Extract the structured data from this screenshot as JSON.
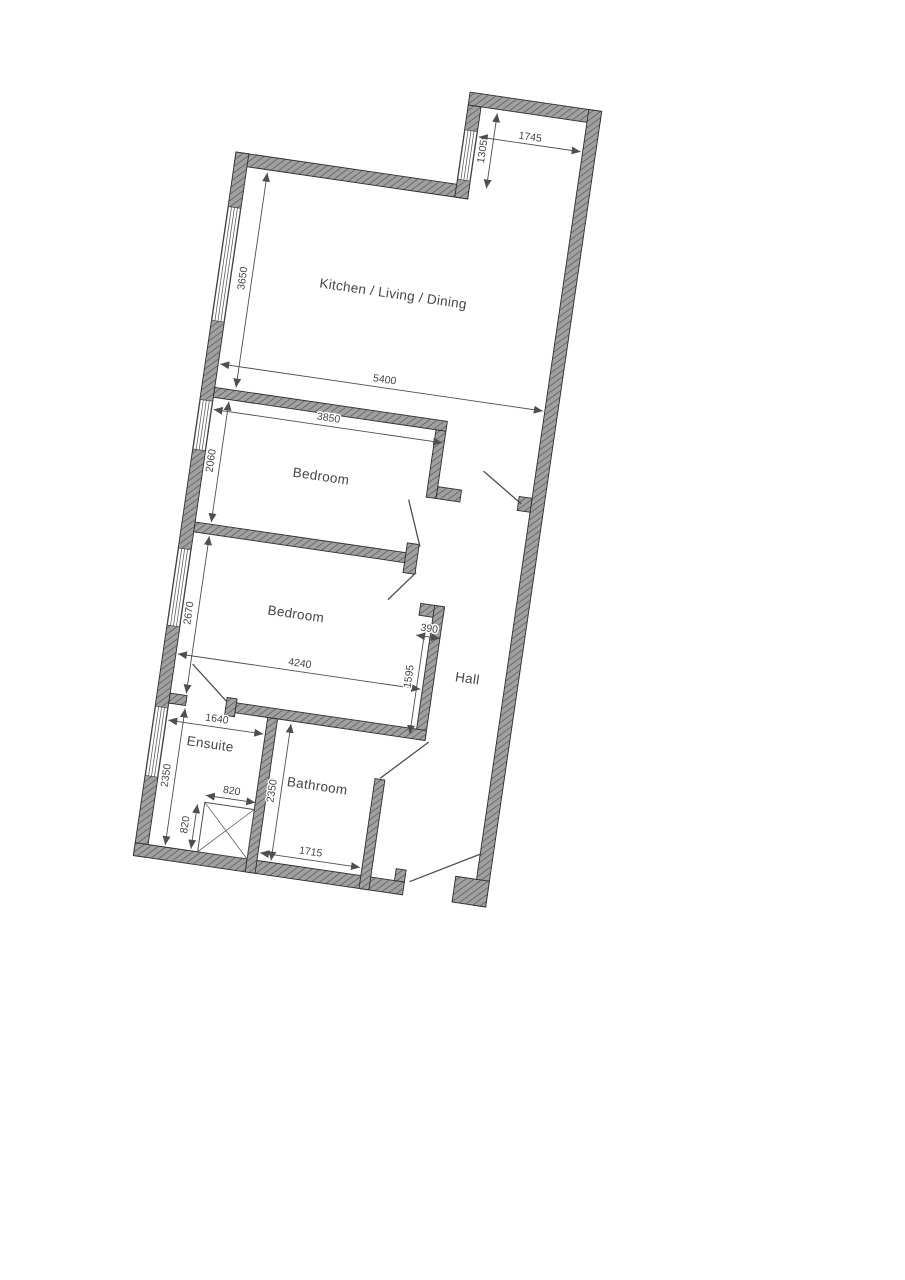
{
  "title": "Apartment floor plan",
  "colors": {
    "bg": "#ffffff",
    "wall_fill": "#a0a0a0",
    "wall_hatch": "#4a4a4a",
    "wall_outline": "#2e2e2e",
    "line": "#4f4f4f",
    "text": "#454545"
  },
  "rooms": {
    "kitchen": "Kitchen / Living / Dining",
    "bedroom1": "Bedroom",
    "bedroom2": "Bedroom",
    "hall": "Hall",
    "ensuite": "Ensuite",
    "bathroom": "Bathroom"
  },
  "dimensions": {
    "notch_width": "1745",
    "notch_depth": "1305",
    "kitchen_depth": "3650",
    "kitchen_width": "5400",
    "bedroom1_width": "3850",
    "bedroom1_depth": "2060",
    "bedroom2_depth": "2670",
    "bedroom2_width": "4240",
    "hall_nib": "390",
    "bedroom2_right": "1595",
    "ensuite_width": "1640",
    "ensuite_depth": "2350",
    "shower_width": "820",
    "shower_depth": "820",
    "bathroom_depth": "2350",
    "bathroom_width": "1715"
  }
}
